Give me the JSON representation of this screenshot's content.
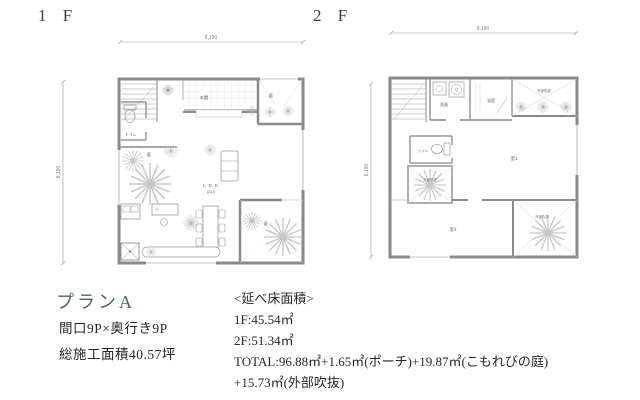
{
  "titles": {
    "floor1": "1 F",
    "floor2": "2 F"
  },
  "plan_1f": {
    "dim_top": "8,190",
    "dim_left": "8,190",
    "labels": {
      "toilet": "トイレ",
      "entrance": "玄関",
      "garden_top": "庭",
      "garden_court": "庭",
      "ldk": "L D K",
      "ldk_size": "(21J)",
      "garden_bottom": "庭"
    }
  },
  "plan_2f": {
    "dim_top": "8,190",
    "dim_left": "8,190",
    "labels": {
      "washroom": "洗面",
      "bathroom": "浴室",
      "void_top": "外部吹抜",
      "toilet": "トイレ",
      "void_mid": "外部吹抜",
      "room1": "室1",
      "room2": "室2",
      "void_bottom": "外部吹抜"
    }
  },
  "summary": {
    "plan_name": "プランA",
    "frontage": "間口9P×奥行き9P",
    "construction_area": "総施工面積40.57坪",
    "floor_area_heading": "<延べ床面積>",
    "area_1f": "1F:45.54㎡",
    "area_2f": "2F:51.34㎡",
    "area_total": "TOTAL:96.88㎡+1.65㎡(ポーチ)+19.87㎡(こもれびの庭)",
    "area_total_cont": "+15.73㎡(外部吹抜)"
  },
  "colors": {
    "accent": "#47685e",
    "text": "#262626",
    "wall": "#8a8a8a",
    "thin_line": "#a8a8a8",
    "foliage": "#c6c6c6",
    "dim": "#8c8c8c"
  }
}
